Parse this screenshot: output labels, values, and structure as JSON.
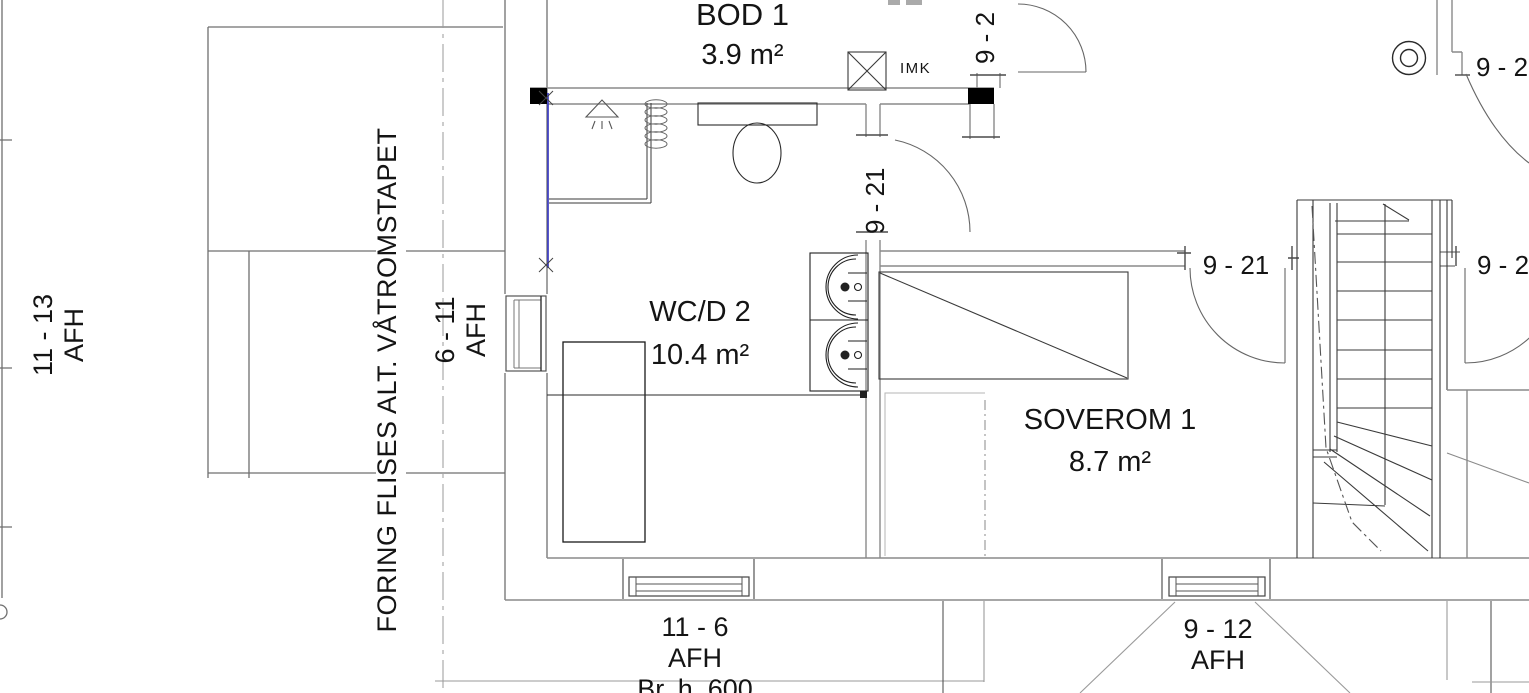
{
  "rooms": {
    "bod1": {
      "name": "BOD 1",
      "area": "3.9 m²"
    },
    "wcd2": {
      "name": "WC/D 2",
      "area": "10.4 m²"
    },
    "soverom1": {
      "name": "SOVEROM 1",
      "area": "8.7 m²"
    }
  },
  "annotations": {
    "imk": "IMK",
    "wall_note": "FORING FLISES ALT. VÅTROMSTAPET"
  },
  "door_labels": {
    "wc_door": "9 - 21",
    "soverom_door": "9 - 21",
    "top_door": "9 - 2",
    "right_door": "9 - 2",
    "top_right_door": "9 - 2"
  },
  "window_labels": {
    "left_outer": [
      "11 - 13",
      "AFH"
    ],
    "left_wall": [
      "6 - 11",
      "AFH"
    ],
    "bottom_left": [
      "11 - 6",
      "AFH",
      "Br. h. 600"
    ],
    "bottom_right": [
      "9 - 12",
      "AFH"
    ]
  },
  "colors": {
    "wall_gray": "#8a8a8a",
    "dark_line": "#2a2a2a",
    "accent_blue": "#3a3ac0"
  }
}
